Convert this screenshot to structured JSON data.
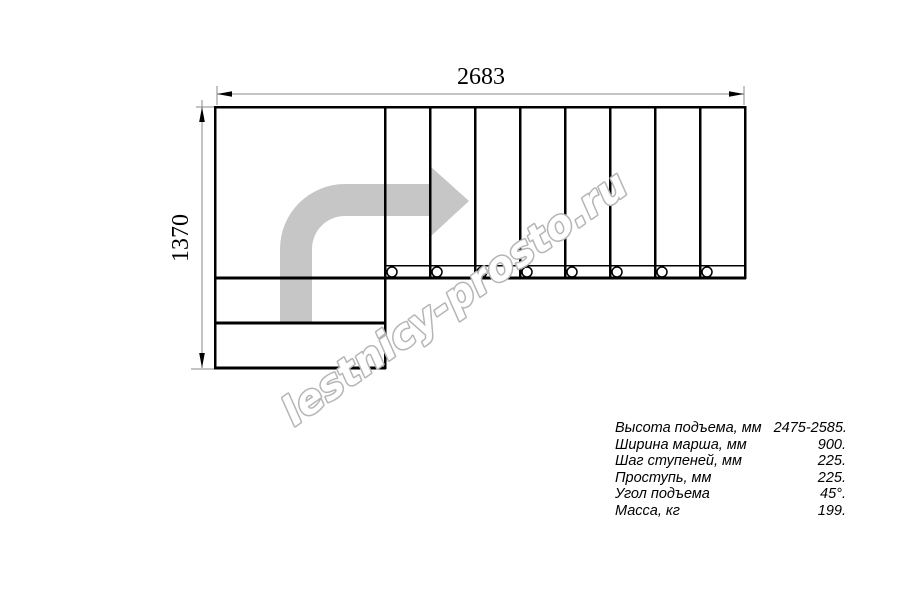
{
  "dimensions": {
    "width_label": "2683",
    "height_label": "1370"
  },
  "watermark": {
    "text": "lestnicy-prosto.ru",
    "outline_color": "#b5b5b5"
  },
  "plan": {
    "type": "staircase-top-view",
    "straight_treads": 8,
    "lower_treads": 2,
    "has_landing": true,
    "direction_arrow_color": "#c6c6c6",
    "line_color": "#000000",
    "dim_line_color": "#8a8a8a"
  },
  "specs": {
    "rows": [
      {
        "label": "Высота подъема, мм",
        "value": "2475-2585."
      },
      {
        "label": "Ширина марша, мм",
        "value": "900."
      },
      {
        "label": "Шаг ступеней, мм",
        "value": "225."
      },
      {
        "label": "Проступь, мм",
        "value": "225."
      },
      {
        "label": "Угол подъема",
        "value": "45°."
      },
      {
        "label": "Масса, кг",
        "value": "199."
      }
    ]
  }
}
